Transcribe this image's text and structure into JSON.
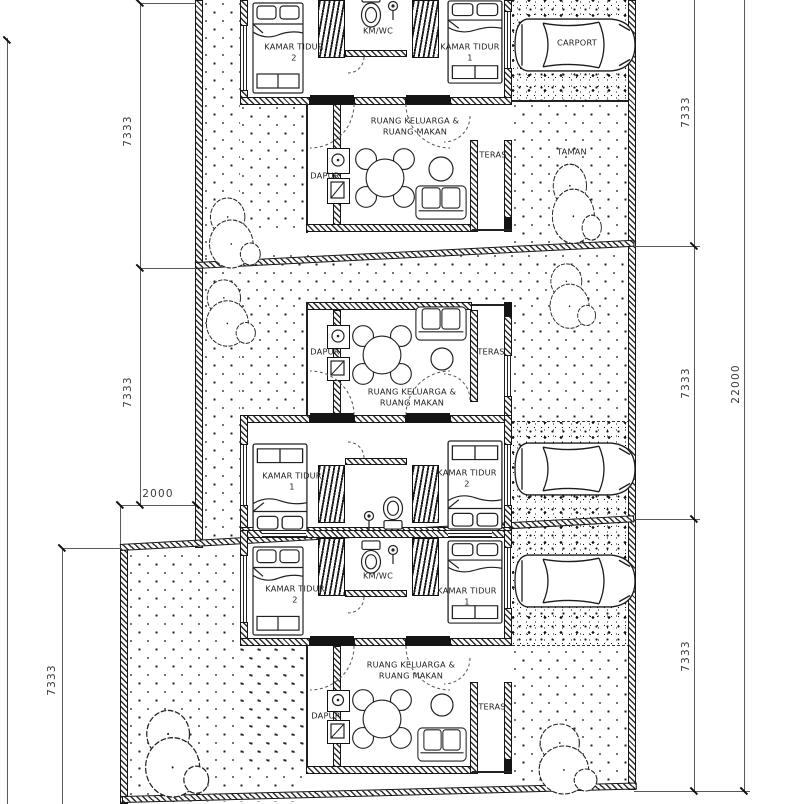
{
  "drawing": {
    "kind": "residential site plan, three row units, black ink on white",
    "palette": {
      "ink": "#1f1f1f",
      "paper": "#ffffff",
      "dim_line": "#5a5a5a"
    }
  },
  "site": {
    "dimensions": {
      "left_top": "7333",
      "left_middle": "7333",
      "left_offset": "2000",
      "left_bottom": "7333",
      "right_top": "7333",
      "right_middle": "7333",
      "right_bottom": "7333",
      "right_total": "22000"
    },
    "units": [
      {
        "bedroom_left": "KAMAR TIDUR\n2",
        "bathroom": "KM/WC",
        "bedroom_right": "KAMAR TIDUR\n1",
        "living": "RUANG KELUARGA &\nRUANG MAKAN",
        "kitchen": "DAPUR",
        "terrace": "TERAS",
        "carport": "CARPORT",
        "garden": "TAMAN"
      },
      {
        "kitchen": "DAPUR",
        "terrace": "TERAS",
        "living": "RUANG KELUARGA &\nRUANG MAKAN",
        "bedroom_left": "KAMAR TIDUR\n1",
        "bedroom_right": "KAMAR TIDUR\n2"
      },
      {
        "bedroom_left": "KAMAR TIDUR\n2",
        "bathroom": "KM/WC",
        "bedroom_right": "KAMAR TIDUR\n1",
        "living": "RUANG KELUARGA &\nRUANG MAKAN",
        "kitchen": "DAPUR",
        "terrace": "TERAS"
      }
    ]
  }
}
